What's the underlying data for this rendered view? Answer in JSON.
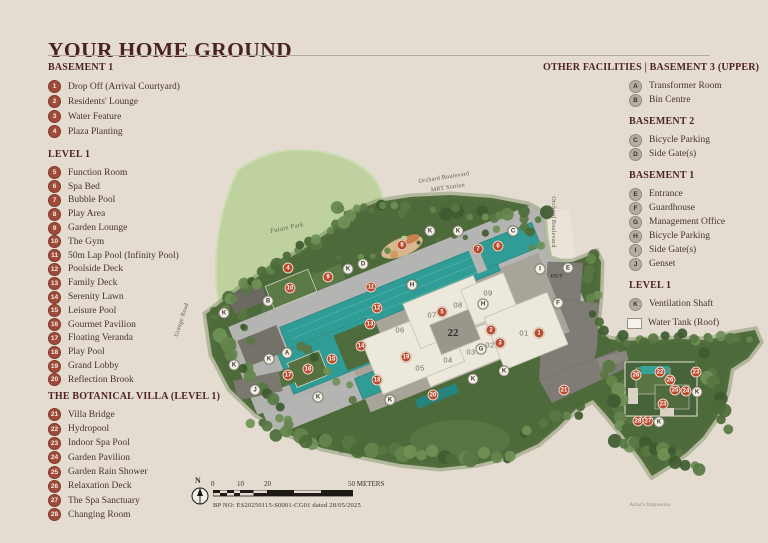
{
  "title": "YOUR HOME GROUND",
  "legend_left": {
    "sections": [
      {
        "heading": "BASEMENT 1",
        "items": [
          {
            "num": "1",
            "label": "Drop Off (Arrival Courtyard)"
          },
          {
            "num": "2",
            "label": "Residents' Lounge"
          },
          {
            "num": "3",
            "label": "Water Feature"
          },
          {
            "num": "4",
            "label": "Plaza Planting"
          }
        ]
      },
      {
        "heading": "LEVEL 1",
        "items": [
          {
            "num": "5",
            "label": "Function Room"
          },
          {
            "num": "6",
            "label": "Spa Bed"
          },
          {
            "num": "7",
            "label": "Bubble Pool"
          },
          {
            "num": "8",
            "label": "Play Area"
          },
          {
            "num": "9",
            "label": "Garden Lounge"
          },
          {
            "num": "10",
            "label": "The Gym"
          },
          {
            "num": "11",
            "label": "50m Lap Pool (Infinity Pool)"
          },
          {
            "num": "12",
            "label": "Poolside Deck"
          },
          {
            "num": "13",
            "label": "Family Deck"
          },
          {
            "num": "14",
            "label": "Serenity Lawn"
          },
          {
            "num": "15",
            "label": "Leisure Pool"
          },
          {
            "num": "16",
            "label": "Gourmet Pavilion"
          },
          {
            "num": "17",
            "label": "Floating Veranda"
          },
          {
            "num": "18",
            "label": "Play Pool"
          },
          {
            "num": "19",
            "label": "Grand Lobby"
          },
          {
            "num": "20",
            "label": "Reflection Brook"
          }
        ]
      },
      {
        "heading": "THE BOTANICAL VILLA (LEVEL 1)",
        "items": [
          {
            "num": "21",
            "label": "Villa Bridge"
          },
          {
            "num": "22",
            "label": "Hydropool"
          },
          {
            "num": "23",
            "label": "Indoor Spa Pool"
          },
          {
            "num": "24",
            "label": "Garden Pavilion"
          },
          {
            "num": "25",
            "label": "Garden Rain Shower"
          },
          {
            "num": "26",
            "label": "Relaxation Deck"
          },
          {
            "num": "27",
            "label": "The Spa Sanctuary"
          },
          {
            "num": "28",
            "label": "Changing Room"
          }
        ]
      }
    ]
  },
  "legend_right": {
    "sections": [
      {
        "heading": "OTHER FACILITIES  |  BASEMENT 3 (UPPER)",
        "items": [
          {
            "num": "A",
            "label": "Transformer Room"
          },
          {
            "num": "B",
            "label": "Bin Centre"
          }
        ]
      },
      {
        "heading": "BASEMENT 2",
        "items": [
          {
            "num": "C",
            "label": "Bicycle Parking"
          },
          {
            "num": "D",
            "label": "Side Gate(s)"
          }
        ]
      },
      {
        "heading": "BASEMENT 1",
        "items": [
          {
            "num": "E",
            "label": "Entrance"
          },
          {
            "num": "F",
            "label": "Guardhouse"
          },
          {
            "num": "G",
            "label": "Management Office"
          },
          {
            "num": "H",
            "label": "Bicycle Parking"
          },
          {
            "num": "I",
            "label": "Side Gate(s)"
          },
          {
            "num": "J",
            "label": "Genset"
          }
        ]
      },
      {
        "heading": "LEVEL 1",
        "items": [
          {
            "num": "K",
            "label": "Ventilation Shaft"
          }
        ]
      }
    ],
    "water_tank_label": "Water Tank (Roof)"
  },
  "map": {
    "road_labels": [
      {
        "t": "Orchard Boulevard",
        "x": 444,
        "y": 178,
        "r": -9,
        "c": "lab-road"
      },
      {
        "t": "MRT Station",
        "x": 448,
        "y": 188,
        "r": -9,
        "c": "lab-road"
      },
      {
        "t": "Orchard Boulevard",
        "x": 553,
        "y": 222,
        "r": 90,
        "c": "lab-road"
      },
      {
        "t": "Grange Road",
        "x": 182,
        "y": 320,
        "r": -72,
        "c": "lab-road"
      },
      {
        "t": "Future Park",
        "x": 287,
        "y": 228,
        "r": -12,
        "c": "lab-park"
      },
      {
        "t": "OUT",
        "x": 557,
        "y": 277,
        "r": 0,
        "c": "lab-out"
      }
    ],
    "unit_labels": [
      {
        "t": "01",
        "x": 524,
        "y": 333
      },
      {
        "t": "02",
        "x": 490,
        "y": 345
      },
      {
        "t": "03",
        "x": 471,
        "y": 352
      },
      {
        "t": "04",
        "x": 448,
        "y": 360
      },
      {
        "t": "05",
        "x": 420,
        "y": 368
      },
      {
        "t": "06",
        "x": 400,
        "y": 330
      },
      {
        "t": "07",
        "x": 432,
        "y": 315
      },
      {
        "t": "08",
        "x": 458,
        "y": 305
      },
      {
        "t": "09",
        "x": 488,
        "y": 293
      }
    ],
    "block_label": {
      "t": "22",
      "x": 453,
      "y": 333
    },
    "markers_numbered": [
      {
        "n": "1",
        "x": 539,
        "y": 333
      },
      {
        "n": "2",
        "x": 491,
        "y": 330
      },
      {
        "n": "3",
        "x": 500,
        "y": 343
      },
      {
        "n": "4",
        "x": 288,
        "y": 268
      },
      {
        "n": "5",
        "x": 442,
        "y": 312
      },
      {
        "n": "6",
        "x": 498,
        "y": 246
      },
      {
        "n": "7",
        "x": 478,
        "y": 249
      },
      {
        "n": "8",
        "x": 402,
        "y": 245
      },
      {
        "n": "9",
        "x": 328,
        "y": 277
      },
      {
        "n": "10",
        "x": 290,
        "y": 288
      },
      {
        "n": "11",
        "x": 371,
        "y": 287
      },
      {
        "n": "12",
        "x": 377,
        "y": 308
      },
      {
        "n": "13",
        "x": 370,
        "y": 324
      },
      {
        "n": "14",
        "x": 361,
        "y": 346
      },
      {
        "n": "15",
        "x": 332,
        "y": 359
      },
      {
        "n": "16",
        "x": 308,
        "y": 369
      },
      {
        "n": "17",
        "x": 288,
        "y": 375
      },
      {
        "n": "18",
        "x": 377,
        "y": 380
      },
      {
        "n": "19",
        "x": 406,
        "y": 357
      },
      {
        "n": "20",
        "x": 433,
        "y": 395
      },
      {
        "n": "21",
        "x": 564,
        "y": 390
      },
      {
        "n": "26",
        "x": 636,
        "y": 375
      },
      {
        "n": "22",
        "x": 660,
        "y": 372
      },
      {
        "n": "23",
        "x": 696,
        "y": 372
      },
      {
        "n": "26",
        "x": 670,
        "y": 380
      },
      {
        "n": "25",
        "x": 675,
        "y": 390
      },
      {
        "n": "24",
        "x": 686,
        "y": 391
      },
      {
        "n": "23",
        "x": 663,
        "y": 404
      },
      {
        "n": "28",
        "x": 638,
        "y": 421
      },
      {
        "n": "27",
        "x": 648,
        "y": 421
      }
    ],
    "markers_lettered": [
      {
        "n": "A",
        "x": 287,
        "y": 353
      },
      {
        "n": "B",
        "x": 268,
        "y": 301
      },
      {
        "n": "C",
        "x": 513,
        "y": 231
      },
      {
        "n": "D",
        "x": 363,
        "y": 264
      },
      {
        "n": "E",
        "x": 568,
        "y": 268
      },
      {
        "n": "F",
        "x": 558,
        "y": 303
      },
      {
        "n": "G",
        "x": 481,
        "y": 349
      },
      {
        "n": "H",
        "x": 412,
        "y": 285
      },
      {
        "n": "H",
        "x": 483,
        "y": 304
      },
      {
        "n": "I",
        "x": 540,
        "y": 269
      },
      {
        "n": "J",
        "x": 255,
        "y": 390
      },
      {
        "n": "K",
        "x": 430,
        "y": 231
      },
      {
        "n": "K",
        "x": 458,
        "y": 231
      },
      {
        "n": "K",
        "x": 348,
        "y": 269
      },
      {
        "n": "K",
        "x": 224,
        "y": 313
      },
      {
        "n": "K",
        "x": 234,
        "y": 365
      },
      {
        "n": "K",
        "x": 269,
        "y": 359
      },
      {
        "n": "K",
        "x": 318,
        "y": 397
      },
      {
        "n": "K",
        "x": 390,
        "y": 400
      },
      {
        "n": "K",
        "x": 473,
        "y": 379
      },
      {
        "n": "K",
        "x": 504,
        "y": 371
      },
      {
        "n": "K",
        "x": 697,
        "y": 392
      },
      {
        "n": "K",
        "x": 659,
        "y": 422
      }
    ]
  },
  "scale_bar": {
    "north": "N",
    "ticks": [
      "0",
      "10",
      "20"
    ],
    "end_label": "50 METERS",
    "bp_text": "BP NO: ES20250115-S0001-CG01 dated 28/05/2025"
  },
  "footnote": "Artist's Impression",
  "colors": {
    "background": "#e4dcd1",
    "heading": "#4a2127",
    "number_badge": "#a04a39",
    "letter_badge": "#b2aea3",
    "map_marker_red": "#b94a30",
    "pool_teal": "#2f9c95",
    "site_green": "#4d6a3a",
    "park_green": "#bed19f"
  }
}
